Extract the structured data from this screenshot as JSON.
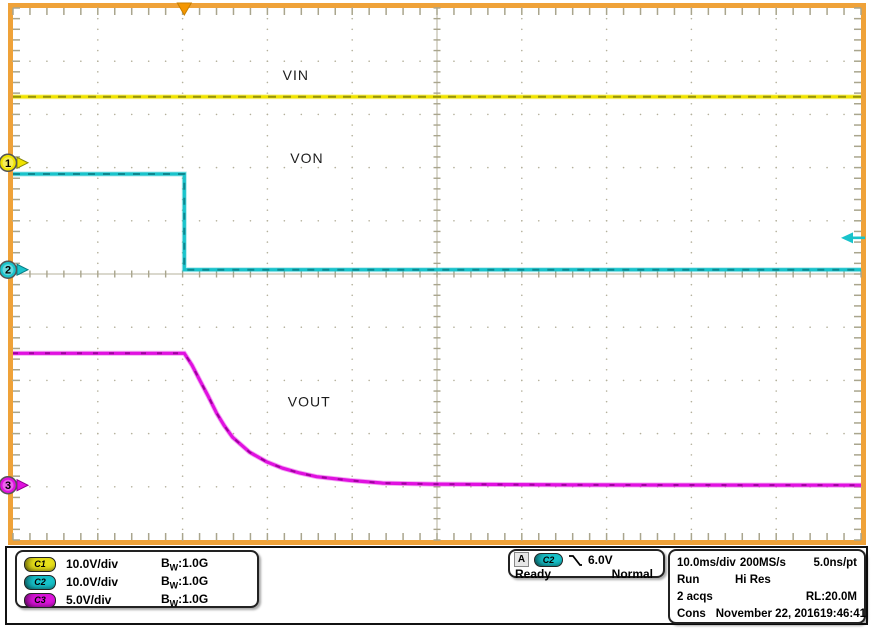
{
  "colors": {
    "screen_bg": "#ffffff",
    "graticule_border": "#efa239",
    "grid": "#b4b09b",
    "edge_tick": "#a9a58d",
    "trigger_position_marker": "#f49600",
    "c1": "#e8e019",
    "c2": "#17c2ca",
    "c3": "#dc13dc",
    "text": "#000000"
  },
  "chart_data": {
    "type": "line",
    "x_axis": {
      "unit": "ms",
      "per_div": 10,
      "divisions": 10
    },
    "y_axis": {
      "divisions": 10
    },
    "trigger": {
      "source": "C2",
      "level_V": 6.0,
      "slope": "falling",
      "position_div": 2.02
    },
    "series": [
      {
        "name": "VIN",
        "channel": "C1",
        "marker": 1,
        "color": "#f0e300",
        "speckle": "#85850a",
        "volts_per_div": 10,
        "zero_div_from_top": 2.91,
        "points": [
          [
            -20.2,
            12.4
          ],
          [
            79.8,
            12.4
          ]
        ]
      },
      {
        "name": "VON",
        "channel": "C2",
        "marker": 2,
        "color": "#19c3cb",
        "speckle": "#0a7d85",
        "volts_per_div": 10,
        "zero_div_from_top": 4.92,
        "points": [
          [
            -20.2,
            18
          ],
          [
            0,
            18
          ],
          [
            0,
            0
          ],
          [
            79.8,
            0
          ]
        ]
      },
      {
        "name": "VOUT",
        "channel": "C3",
        "marker": 3,
        "color": "#e011e0",
        "speckle": "#90008f",
        "volts_per_div": 5,
        "zero_div_from_top": 8.97,
        "points": [
          [
            -20.2,
            12.4
          ],
          [
            0,
            12.4
          ],
          [
            0.9,
            11.3
          ],
          [
            1.8,
            9.9
          ],
          [
            2.8,
            8.4
          ],
          [
            3.8,
            6.8
          ],
          [
            4.7,
            5.6
          ],
          [
            5.7,
            4.5
          ],
          [
            7.7,
            3.1
          ],
          [
            9.7,
            2.2
          ],
          [
            11.6,
            1.6
          ],
          [
            13.6,
            1.15
          ],
          [
            15.6,
            0.8
          ],
          [
            19.5,
            0.45
          ],
          [
            23.4,
            0.2
          ],
          [
            29.3,
            0.1
          ],
          [
            45,
            0.03
          ],
          [
            79.8,
            0
          ]
        ]
      }
    ],
    "annotations": [
      {
        "text": "VIN",
        "x_div": 3.18,
        "y_div": 1.26
      },
      {
        "text": "VON",
        "x_div": 3.27,
        "y_div": 2.82
      },
      {
        "text": "VOUT",
        "x_div": 3.24,
        "y_div": 7.4
      }
    ]
  },
  "readouts": {
    "channels": [
      {
        "id": "C1",
        "scale": "10.0V/div",
        "bw_prefix": "B",
        "bw_sub": "W",
        "bw_value": ":1.0G"
      },
      {
        "id": "C2",
        "scale": "10.0V/div",
        "bw_prefix": "B",
        "bw_sub": "W",
        "bw_value": ":1.0G"
      },
      {
        "id": "C3",
        "scale": "5.0V/div",
        "bw_prefix": "B",
        "bw_sub": "W",
        "bw_value": ":1.0G"
      }
    ],
    "trigger_box": {
      "mode": "A",
      "source": "C2",
      "level": "6.0V",
      "state": "Ready",
      "type": "Normal"
    },
    "horizontal_box": {
      "time_per_div": "10.0ms/div",
      "sample_rate": "200MS/s",
      "resolution": "5.0ns/pt",
      "run_state": "Run",
      "acq_mode": "Hi Res",
      "acquisitions": "2 acqs",
      "record_length": "RL:20.0M",
      "console_label": "Cons",
      "date": "November 22, 2016",
      "time": "19:46:41"
    }
  }
}
